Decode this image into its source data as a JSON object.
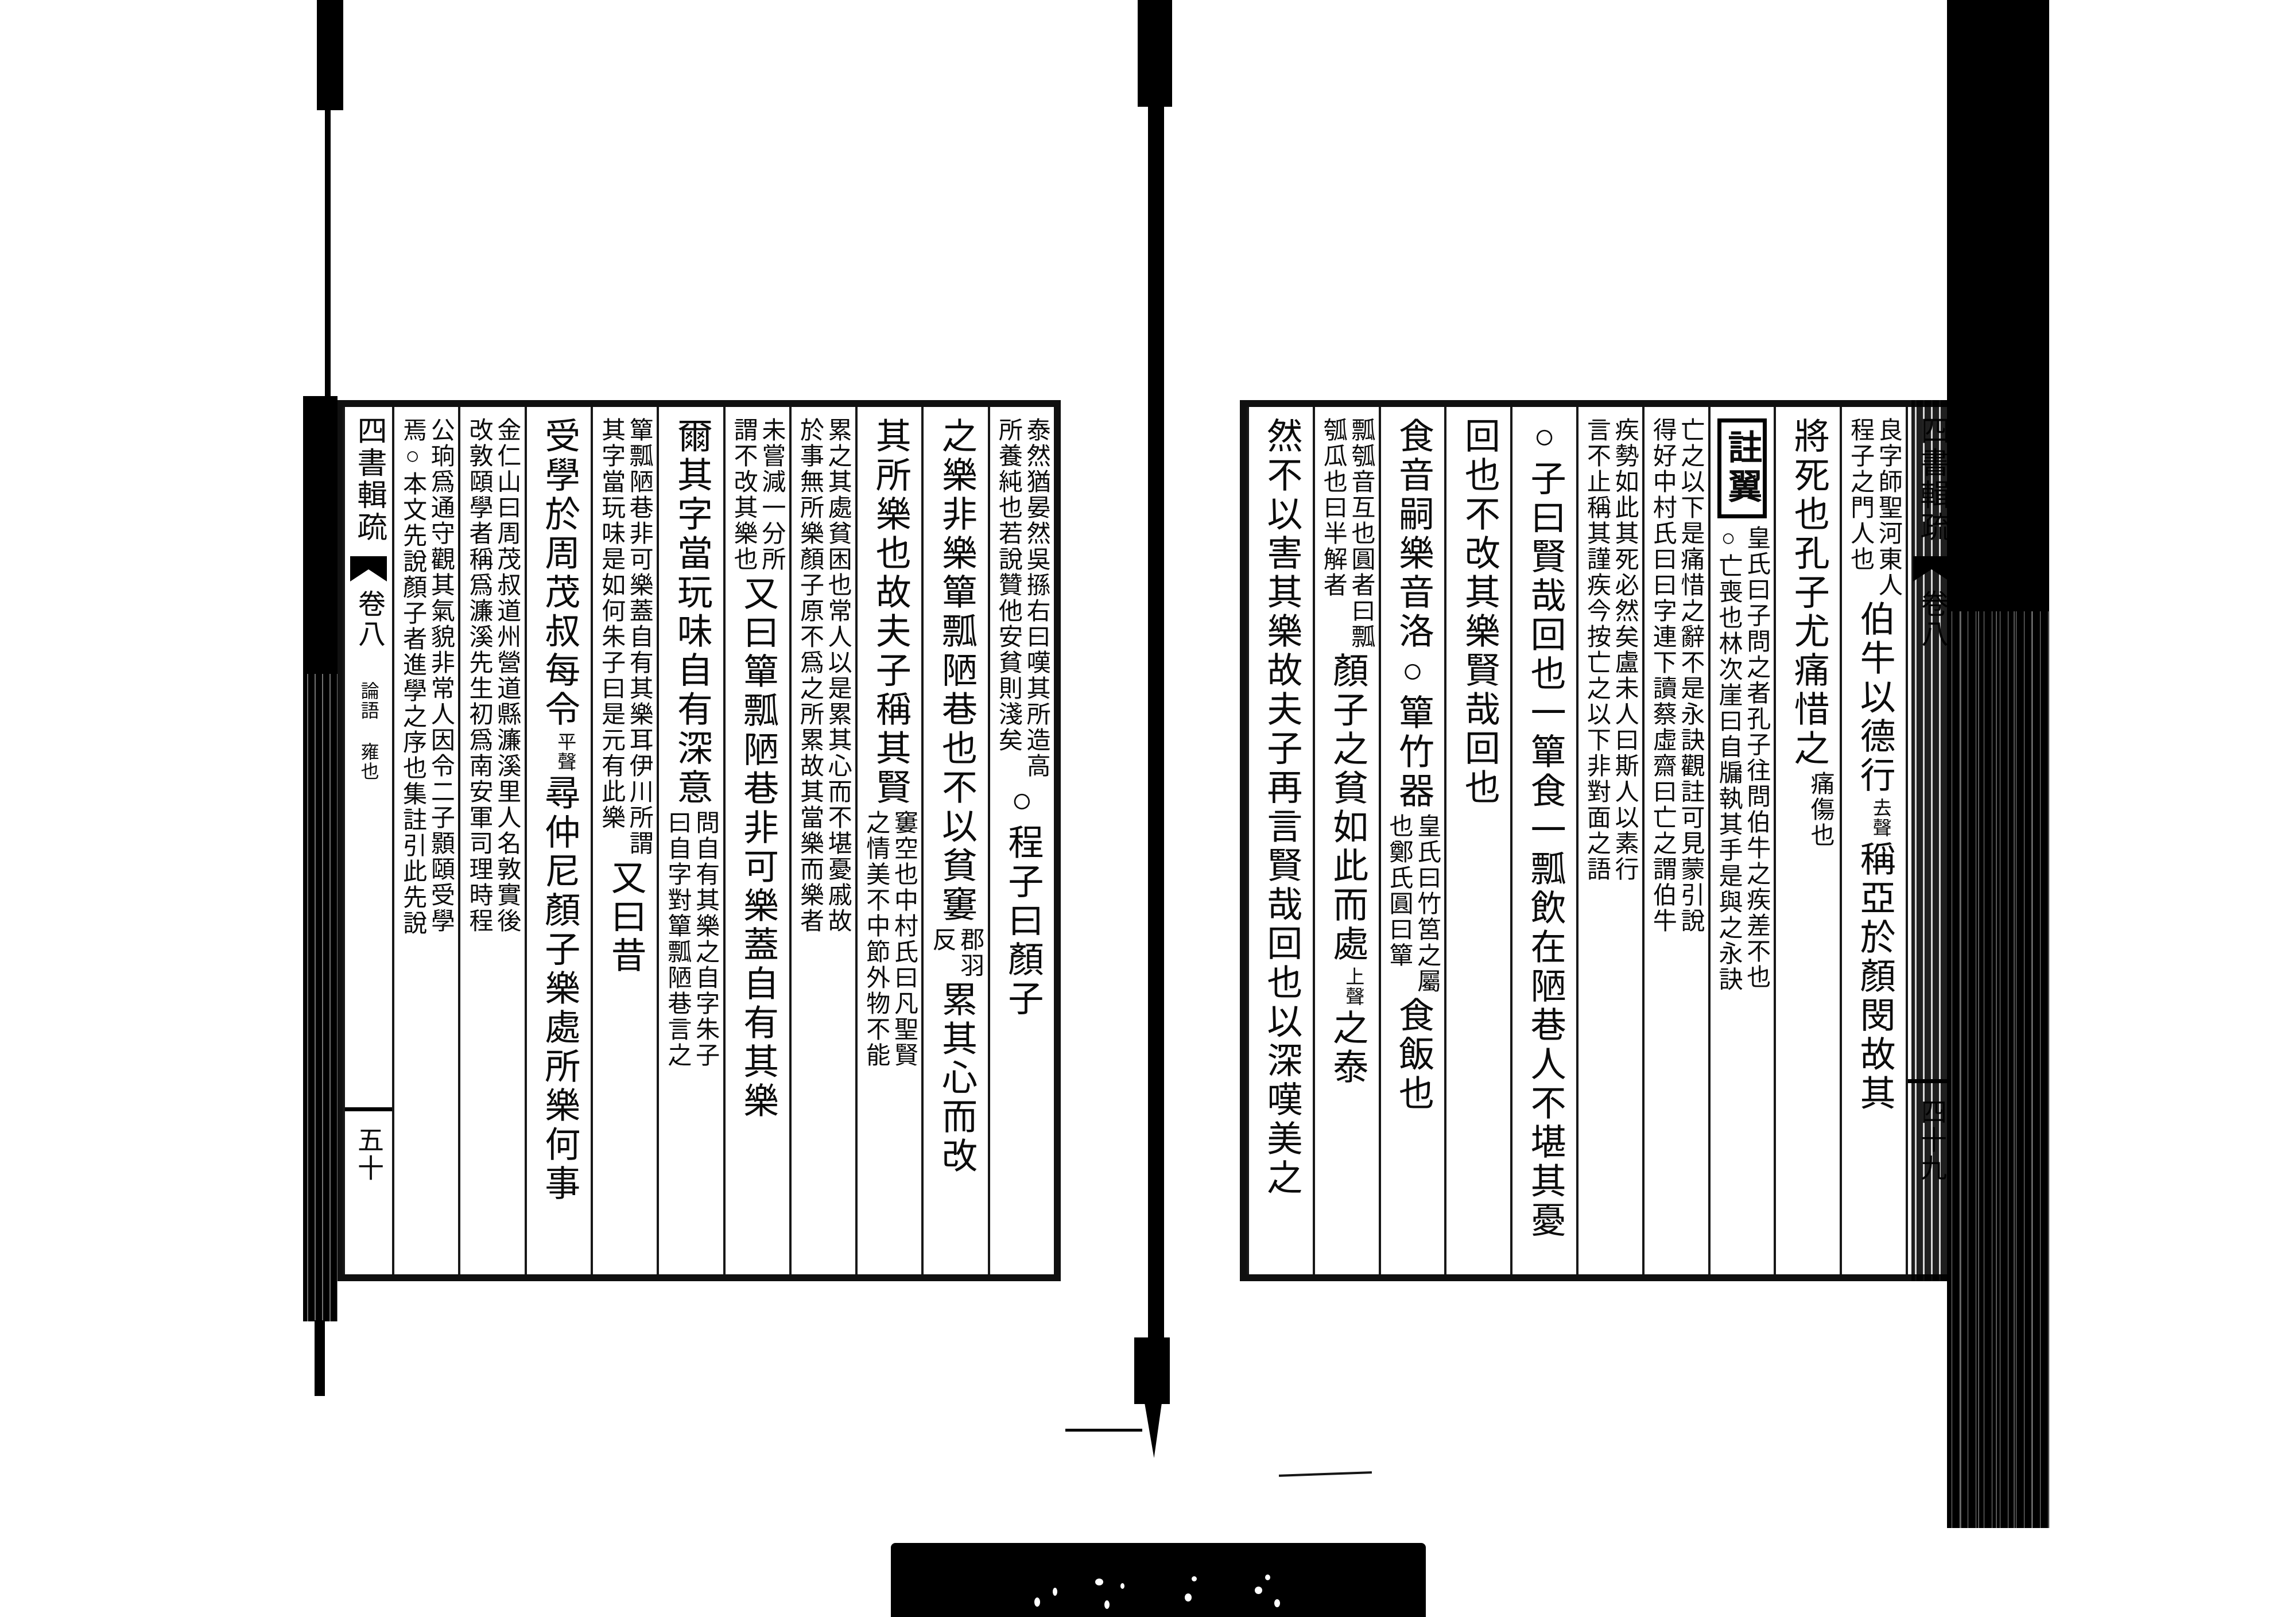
{
  "work": {
    "title": "四書輯疏",
    "volume": "卷八",
    "section": "論語 雍也"
  },
  "page_right": {
    "spine": {
      "title": "四書輯疏",
      "volume": "卷八",
      "page_number": "四十九"
    },
    "columns": [
      {
        "segments": [
          {
            "t": "small2",
            "right": "良字師聖河東人",
            "left": "程子之門人也"
          },
          {
            "t": "large",
            "text": "伯牛以德行"
          },
          {
            "t": "gloss",
            "text": "去聲"
          },
          {
            "t": "large",
            "text": "稱亞於顏閔故其"
          }
        ]
      },
      {
        "segments": [
          {
            "t": "large",
            "text": "將死也孔子尤痛惜之"
          },
          {
            "t": "small2",
            "right": "痛傷也",
            "left": ""
          }
        ]
      },
      {
        "segments": [
          {
            "t": "box",
            "text": "註翼"
          },
          {
            "t": "small2",
            "right": "皇氏曰子問之者孔子往問伯牛之疾差不也",
            "left": "○亡喪也林次崖曰自牖執其手是與之永訣"
          }
        ]
      },
      {
        "segments": [
          {
            "t": "small2",
            "right": "亡之以下是痛惜之辭不是永訣觀註可見蒙引說",
            "left": "得好中村氏曰曰字連下讀蔡虛齋曰亡之謂伯牛"
          }
        ]
      },
      {
        "segments": [
          {
            "t": "small2",
            "right": "疾勢如此其死必然矣盧未人曰斯人以素行",
            "left": "言不止稱其謹疾今按亡之以下非對面之語"
          }
        ]
      },
      {
        "segments": [
          {
            "t": "large",
            "text": "○子曰賢哉回也一簞食一瓢飲在陋巷人不堪其憂"
          }
        ]
      },
      {
        "segments": [
          {
            "t": "large",
            "text": "回也不改其樂賢哉回也"
          }
        ]
      },
      {
        "segments": [
          {
            "t": "large",
            "text": "食音嗣樂音洛○簞竹器"
          },
          {
            "t": "small2",
            "right": "皇氏曰竹筥之屬",
            "left": "也鄭氏圓曰簞"
          },
          {
            "t": "large",
            "text": "食飯也"
          }
        ]
      },
      {
        "segments": [
          {
            "t": "small2",
            "right": "瓢瓠音互也圓者曰瓢",
            "left": "瓠瓜也曰半解者"
          },
          {
            "t": "large",
            "text": "顏子之貧如此而處"
          },
          {
            "t": "gloss",
            "text": "上聲"
          },
          {
            "t": "large",
            "text": "之泰"
          }
        ]
      },
      {
        "segments": [
          {
            "t": "large",
            "text": "然不以害其樂故夫子再言賢哉回也以深嘆美之"
          }
        ]
      }
    ]
  },
  "page_left": {
    "spine": {
      "title": "四書輯疏",
      "volume": "卷八",
      "section": "論語 雍也",
      "page_number": "五十"
    },
    "columns": [
      {
        "segments": [
          {
            "t": "small2",
            "right": "泰然猶晏然吳搎右曰嘆其所造高",
            "left": "所養純也若說贊他安貧則淺矣"
          },
          {
            "t": "large",
            "text": "○程子曰顏子"
          }
        ]
      },
      {
        "segments": [
          {
            "t": "large",
            "text": "之樂非樂簞瓢陋巷也不以貧窶"
          },
          {
            "t": "small2",
            "right": "郡羽",
            "left": "反"
          },
          {
            "t": "large",
            "text": "累其心而改"
          }
        ]
      },
      {
        "segments": [
          {
            "t": "large",
            "text": "其所樂也故夫子稱其賢"
          },
          {
            "t": "small2",
            "right": "窶空也中村氏曰凡聖賢",
            "left": "之情美不中節外物不能"
          }
        ]
      },
      {
        "segments": [
          {
            "t": "small2",
            "right": "累之其處貧困也常人以是累其心而不堪憂戚故",
            "left": "於事無所樂顏子原不爲之所累故其當樂而樂者"
          }
        ]
      },
      {
        "segments": [
          {
            "t": "small2",
            "right": "未嘗減一分所",
            "left": "謂不改其樂也"
          },
          {
            "t": "large",
            "text": "又曰簞瓢陋巷非可樂蓋自有其樂"
          }
        ]
      },
      {
        "segments": [
          {
            "t": "large",
            "text": "爾其字當玩味自有深意"
          },
          {
            "t": "small2",
            "right": "問自有其樂之自字朱子",
            "left": "曰自字對簞瓢陋巷言之"
          }
        ]
      },
      {
        "segments": [
          {
            "t": "small2",
            "right": "簞瓢陋巷非可樂蓋自有其樂耳伊川所謂",
            "left": "其字當玩味是如何朱子曰是元有此樂"
          },
          {
            "t": "large",
            "text": "又曰昔"
          }
        ]
      },
      {
        "segments": [
          {
            "t": "large",
            "text": "受學於周茂叔每令"
          },
          {
            "t": "gloss",
            "text": "平聲"
          },
          {
            "t": "large",
            "text": "尋仲尼顏子樂處所樂何事"
          }
        ]
      },
      {
        "segments": [
          {
            "t": "small2",
            "right": "金仁山曰周茂叔道州營道縣濂溪里人名敦實後",
            "left": "改敦頤學者稱爲濂溪先生初爲南安軍司理時程"
          }
        ]
      },
      {
        "segments": [
          {
            "t": "small2",
            "right": "公珦爲通守觀其氣貌非常人因令二子顥頤受學",
            "left": "焉○本文先說顏子者進學之序也集註引此先說"
          }
        ]
      }
    ]
  }
}
